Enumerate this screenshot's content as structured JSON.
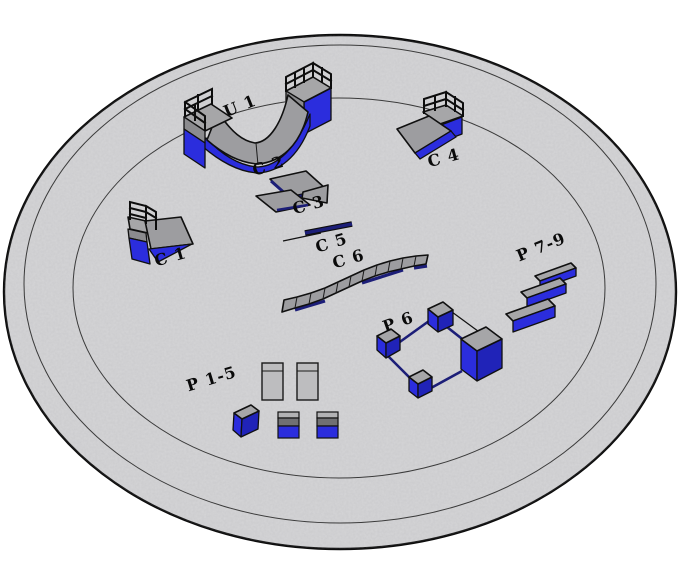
{
  "labels": {
    "u1": "U 1",
    "c1": "C 1",
    "c2": "C 2",
    "c3": "C 3",
    "c4": "C 4",
    "c5": "C 5",
    "c6": "C 6",
    "p1_5": "P 1-5",
    "p6": "P 6",
    "p7_9": "P 7-9"
  },
  "colors": {
    "ground": "#d5d5d7",
    "ground-edge": "#0d0d0d",
    "blue": "#2b2ddd",
    "blue-dark": "#2023b8",
    "navy": "#1c1e78",
    "ramp-gray": "#9d9da0",
    "deck-gray": "#a6a6a8",
    "side-gray": "#8b8b8e",
    "panel-gray": "#bdbdbf",
    "cube-mid-gray": "#707073",
    "label": "#0a0a0a"
  }
}
